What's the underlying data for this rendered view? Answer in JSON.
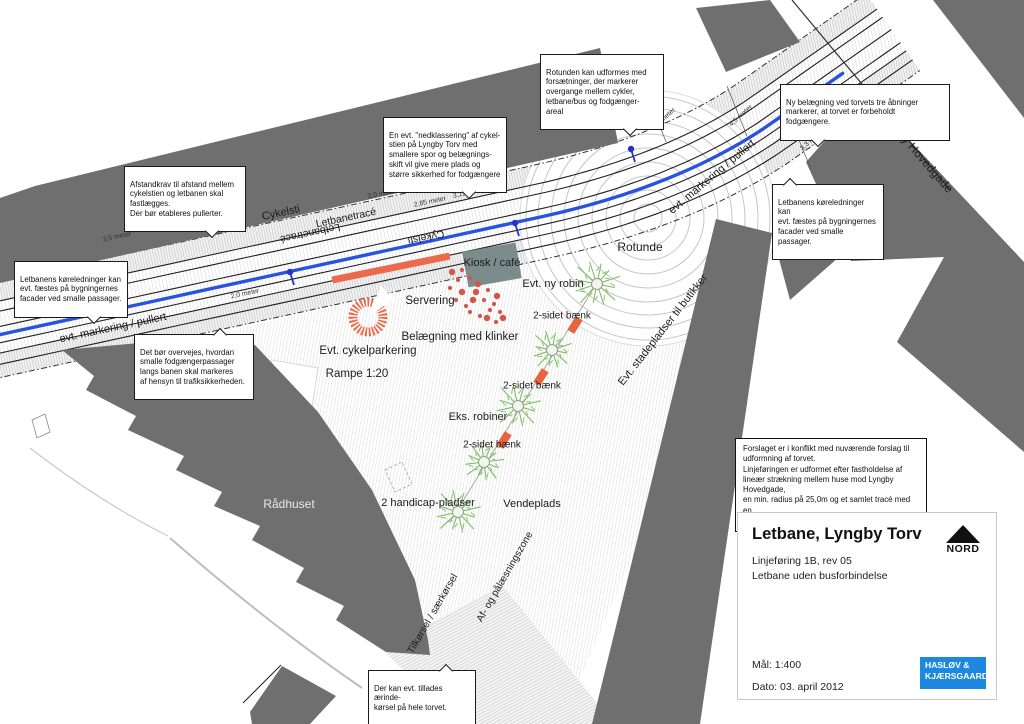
{
  "map_labels": {
    "cykelsti_upper": "Cykelsti",
    "letbanetrace_upper": "Letbanetracé",
    "letbanetrace_flipped": "Letbanetracé",
    "cykelsti_flipped": "Cykelsti",
    "evt_markering_left": "evt. markering / pullert",
    "evt_markering_right": "evt. markering / pullert",
    "lyngby_hovedgade": "Lyngby Hovedgade",
    "rotunde": "Rotunde",
    "kiosk_cafe": "Kiosk / café",
    "servering": "Servering",
    "belaegning": "Belægning med klinker",
    "evt_ny_robin": "Evt. ny robin",
    "baenk_1": "2-sidet bænk",
    "baenk_2": "2-sidet bænk",
    "baenk_3": "2-sidet bænk",
    "eks_robiner": "Eks. robiner",
    "stadepladser": "Evt. stadepladser til butikker",
    "cykelparkering": "Evt. cykelparkering",
    "rampe": "Rampe 1:20",
    "raadhuset": "Rådhuset",
    "handicap": "2 handicap-pladser",
    "vendeplads": "Vendeplads",
    "tilkoersel": "Tilkørsel / særkørsel",
    "af_og": "Af- og pålæsningszone"
  },
  "measurements": {
    "m1": "3,5 meter",
    "m2": "2,0 meter",
    "m3": "2,85 meter",
    "m4": "3,15 meter",
    "m5": "2,0 meter",
    "m6": "3,3 meter",
    "m7": "4,5 meter",
    "m8": "3,3 meter"
  },
  "callouts": {
    "afstandskrav": "Afstandkrav til afstand mellem\ncykelstien og letbanen skal\nfastlægges.\nDer bør etableres pullerter.",
    "koereledninger_left": "Letbanens køreledninger kan\nevt. fæstes på bygningernes\nfacader ved smalle passager.",
    "det_boer": "Det bør overvejes, hvordan\nsmalle fodgængerpassager\nlangs banen skal markeres\naf hensyn til trafiksikkerheden.",
    "nedklassering": "En evt. \"nedklassering\" af cykel-\nstien på Lyngby Torv med\nsmallere spor og belægnings-\nskift vil give mere plads og\nstørre sikkerhed for fodgængere",
    "rotunden": "Rotunden kan udformes med\nforsætninger, der markerer\novergange mellem cykler,\nletbane/bus og fodgænger-\nareal",
    "ny_belaegning": "Ny belægning ved torvets tre åbninger\nmarkerer, at torvet er forbeholdt\nfodgængere.",
    "koereledninger_right": "Letbanens køreledninger kan\nevt. fæstes på bygningernes\nfacader ved smalle passager.",
    "aerindekoersel": "Der kan evt. tillades ærinde-\nkørsel på hele torvet."
  },
  "note_box": "Forslaget er i konflikt med nuværende forslag til\nudformning af torvet.\nLinjeføringen er udformet efter fastholdelse af\nlineær strækning mellem huse mod Lyngby Hovedgade,\nen min. radius på 25,0m og et samlet tracé med en\nbredde på 10,5 / 12,2m inkl. cykelsti.",
  "title_block": {
    "title": "Letbane, Lyngby Torv",
    "line1": "Linjeføring 1B, rev 05",
    "line2": "Letbane uden busforbindelse",
    "scale": "Mål: 1:400",
    "date": "Dato: 03. april 2012",
    "north_label": "NORD",
    "logo_line1": "HASLØV &",
    "logo_line2": "KJÆRSGAARD"
  },
  "colors": {
    "track_blue": "#2a52e0",
    "accent_orange": "#ec6a4c",
    "building_gray": "#6f6f6f",
    "tree_green": "#7fbe63",
    "logo_blue": "#1e88e0"
  }
}
